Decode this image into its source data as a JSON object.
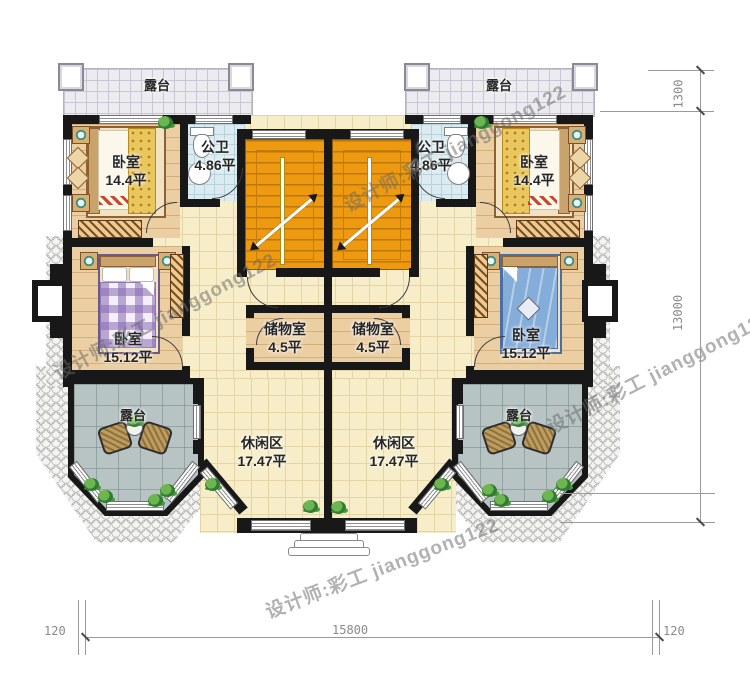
{
  "plan": {
    "rooms": {
      "terrace_tl": {
        "label": "露台"
      },
      "terrace_tr": {
        "label": "露台"
      },
      "bedroom_tl": {
        "label": "卧室",
        "area": "14.4平"
      },
      "bedroom_tr": {
        "label": "卧室",
        "area": "14.4平"
      },
      "bath_l": {
        "label": "公卫",
        "area": "4.86平"
      },
      "bath_r": {
        "label": "公卫",
        "area": "4.86平"
      },
      "bedroom_bl": {
        "label": "卧室",
        "area": "15.12平"
      },
      "bedroom_br": {
        "label": "卧室",
        "area": "15.12平"
      },
      "storage_l": {
        "label": "储物室",
        "area": "4.5平"
      },
      "storage_r": {
        "label": "储物室",
        "area": "4.5平"
      },
      "leisure_l": {
        "label": "休闲区",
        "area": "17.47平"
      },
      "leisure_r": {
        "label": "休闲区",
        "area": "17.47平"
      },
      "terrace_bl": {
        "label": "露台"
      },
      "terrace_br": {
        "label": "露台"
      }
    },
    "dimensions": {
      "terrace_depth": "1300",
      "total_depth": "13000",
      "wall_left": "120",
      "total_width": "15800",
      "wall_right": "120"
    },
    "watermark": "设计师:彩工 jianggong122",
    "colors": {
      "wall": "#181818",
      "stair_orange": "#ee9a10",
      "floor_tile": "#f7eec9",
      "floor_wood": "#ebcfa3",
      "bath_tile": "#dcebf0",
      "terrace_stone": "#b7c4c3"
    }
  }
}
